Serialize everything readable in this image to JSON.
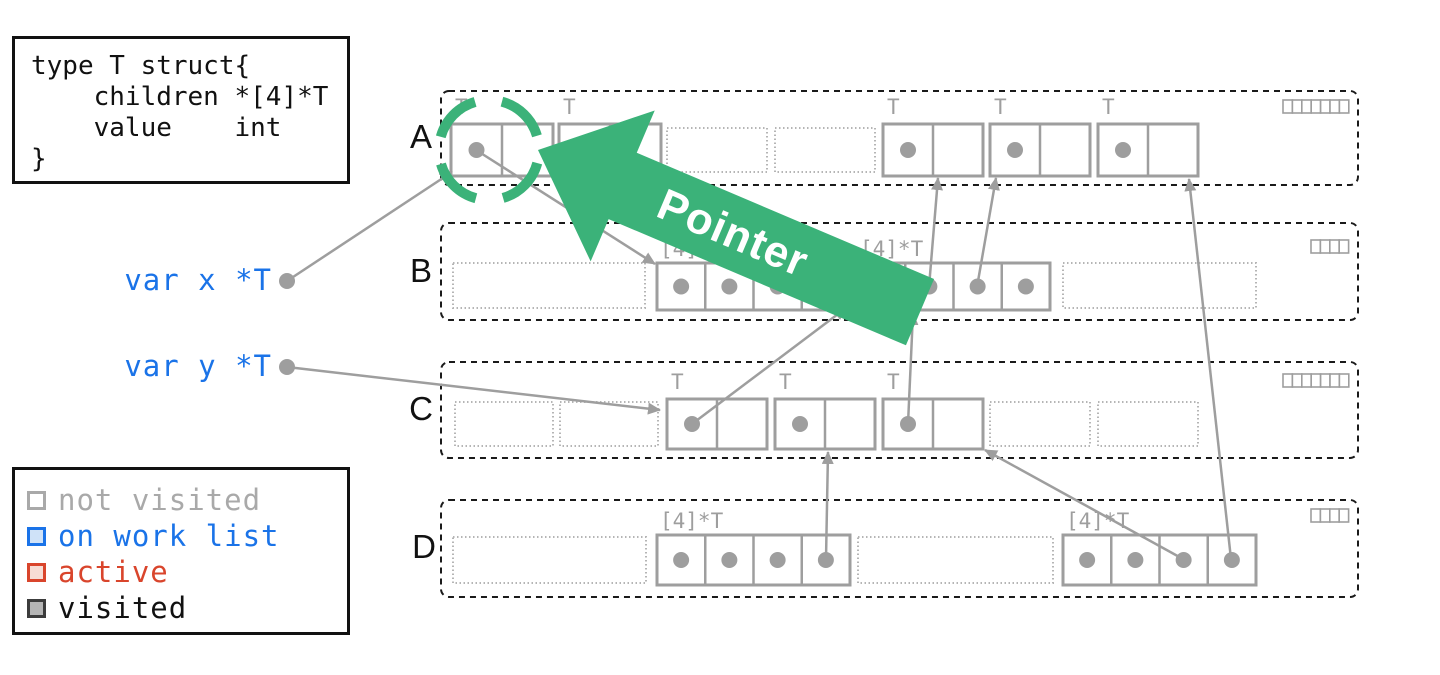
{
  "canvas": {
    "w": 1440,
    "h": 675
  },
  "colors": {
    "object_stroke": "#9e9e9e",
    "free_stroke": "#b5b5b5",
    "dot": "#9e9e9e",
    "edge": "#9e9e9e",
    "row_border": "#1a1a1a",
    "label_gray": "#9e9e9e",
    "text_black": "#111111",
    "blue": "#1a73e8",
    "green": "#3bb279",
    "white": "#ffffff"
  },
  "code_box": {
    "lines": [
      "type T struct{",
      "    children *[4]*T",
      "    value    int",
      "}"
    ]
  },
  "legend": {
    "items": [
      {
        "label": "not visited",
        "swatch_stroke": "#a9a9a9",
        "swatch_fill": "#ffffff",
        "text_color": "#a9a9a9"
      },
      {
        "label": "on work list",
        "swatch_stroke": "#1a73e8",
        "swatch_fill": "#cfe2f8",
        "text_color": "#1a73e8"
      },
      {
        "label": "active",
        "swatch_stroke": "#d9452c",
        "swatch_fill": "#f7dcd4",
        "text_color": "#d9452c"
      },
      {
        "label": "visited",
        "swatch_stroke": "#3c3c3c",
        "swatch_fill": "#b5b5b5",
        "text_color": "#111111"
      }
    ]
  },
  "variables": [
    {
      "label": "var x *T",
      "text_x": 272,
      "text_y": 290,
      "dot_x": 287,
      "dot_y": 281
    },
    {
      "label": "var y *T",
      "text_x": 272,
      "text_y": 376,
      "dot_x": 287,
      "dot_y": 367
    }
  ],
  "pointer_arrow": {
    "label": "Pointer",
    "tip_x": 538,
    "tip_y": 150,
    "angle": 23,
    "length": 415,
    "half_width": 36,
    "head_len": 92,
    "head_half_width": 82,
    "text_along": 212,
    "text_size": 44
  },
  "focus_ring": {
    "cx": 489,
    "cy": 150,
    "r": 50,
    "stroke_width": 10,
    "dash": "51 27.5",
    "rotate": -75
  },
  "rows": [
    {
      "label": "A",
      "label_x": 421,
      "label_y": 148,
      "box": {
        "x": 441,
        "y": 91,
        "w": 917,
        "h": 94
      },
      "mini": {
        "x": 1283,
        "y": 100,
        "count": 7,
        "cw": 9.4,
        "ch": 13
      },
      "objects": [
        {
          "kind": "struct",
          "x": 451,
          "y": 124,
          "w": 102,
          "h": 52,
          "label": "T",
          "dot": true
        },
        {
          "kind": "struct",
          "x": 559,
          "y": 124,
          "w": 102,
          "h": 52,
          "label": "T",
          "dot": true
        },
        {
          "kind": "free",
          "x": 667,
          "y": 128,
          "w": 100,
          "h": 44
        },
        {
          "kind": "free",
          "x": 775,
          "y": 128,
          "w": 100,
          "h": 44
        },
        {
          "kind": "struct",
          "x": 883,
          "y": 124,
          "w": 100,
          "h": 52,
          "label": "T",
          "dot": true
        },
        {
          "kind": "struct",
          "x": 990,
          "y": 124,
          "w": 100,
          "h": 52,
          "label": "T",
          "dot": true
        },
        {
          "kind": "struct",
          "x": 1098,
          "y": 124,
          "w": 100,
          "h": 52,
          "label": "T",
          "dot": true
        }
      ]
    },
    {
      "label": "B",
      "label_x": 421,
      "label_y": 282,
      "box": {
        "x": 441,
        "y": 223,
        "w": 917,
        "h": 97
      },
      "mini": {
        "x": 1311,
        "y": 240,
        "count": 4,
        "cw": 9.4,
        "ch": 13
      },
      "objects": [
        {
          "kind": "freewide",
          "x": 453,
          "y": 263,
          "w": 192,
          "h": 45
        },
        {
          "kind": "array",
          "x": 657,
          "y": 263,
          "w": 193,
          "h": 47,
          "label": "[4]*T",
          "cells": 4,
          "dots": [
            1,
            1,
            1,
            1
          ]
        },
        {
          "kind": "array",
          "x": 857,
          "y": 263,
          "w": 193,
          "h": 47,
          "label": "[4]*T",
          "cells": 4,
          "dots": [
            1,
            1,
            1,
            1
          ]
        },
        {
          "kind": "freewide",
          "x": 1063,
          "y": 263,
          "w": 193,
          "h": 45
        }
      ]
    },
    {
      "label": "C",
      "label_x": 421,
      "label_y": 420,
      "box": {
        "x": 441,
        "y": 362,
        "w": 917,
        "h": 96
      },
      "mini": {
        "x": 1283,
        "y": 374,
        "count": 7,
        "cw": 9.4,
        "ch": 13
      },
      "objects": [
        {
          "kind": "free",
          "x": 455,
          "y": 402,
          "w": 98,
          "h": 44
        },
        {
          "kind": "free",
          "x": 560,
          "y": 402,
          "w": 98,
          "h": 44
        },
        {
          "kind": "struct",
          "x": 667,
          "y": 399,
          "w": 100,
          "h": 50,
          "label": "T",
          "dot": true
        },
        {
          "kind": "struct",
          "x": 775,
          "y": 399,
          "w": 100,
          "h": 50,
          "label": "T",
          "dot": true
        },
        {
          "kind": "struct",
          "x": 883,
          "y": 399,
          "w": 100,
          "h": 50,
          "label": "T",
          "dot": true
        },
        {
          "kind": "free",
          "x": 990,
          "y": 402,
          "w": 100,
          "h": 44
        },
        {
          "kind": "free",
          "x": 1098,
          "y": 402,
          "w": 100,
          "h": 44
        }
      ]
    },
    {
      "label": "D",
      "label_x": 424,
      "label_y": 558,
      "box": {
        "x": 441,
        "y": 500,
        "w": 917,
        "h": 97
      },
      "mini": {
        "x": 1311,
        "y": 509,
        "count": 4,
        "cw": 9.4,
        "ch": 13
      },
      "objects": [
        {
          "kind": "freewide",
          "x": 453,
          "y": 537,
          "w": 193,
          "h": 46
        },
        {
          "kind": "array",
          "x": 657,
          "y": 535,
          "w": 193,
          "h": 50,
          "label": "[4]*T",
          "cells": 4,
          "dots": [
            1,
            1,
            1,
            1
          ]
        },
        {
          "kind": "freewide",
          "x": 858,
          "y": 537,
          "w": 195,
          "h": 46
        },
        {
          "kind": "array",
          "x": 1063,
          "y": 535,
          "w": 193,
          "h": 50,
          "label": "[4]*T",
          "cells": 4,
          "dots": [
            1,
            1,
            1,
            1
          ]
        }
      ]
    }
  ],
  "edges": [
    {
      "x1": 287,
      "y1": 281,
      "x2": 452,
      "y2": 172
    },
    {
      "x1": 476,
      "y1": 150,
      "x2": 655,
      "y2": 264
    },
    {
      "x1": 287,
      "y1": 367,
      "x2": 660,
      "y2": 410
    },
    {
      "x1": 692,
      "y1": 424,
      "x2": 846,
      "y2": 308
    },
    {
      "x1": 908,
      "y1": 424,
      "x2": 913,
      "y2": 313
    },
    {
      "x1": 929,
      "y1": 287,
      "x2": 938,
      "y2": 178
    },
    {
      "x1": 977,
      "y1": 287,
      "x2": 996,
      "y2": 178
    },
    {
      "x1": 826,
      "y1": 559,
      "x2": 828,
      "y2": 452
    },
    {
      "x1": 1183,
      "y1": 559,
      "x2": 985,
      "y2": 450
    },
    {
      "x1": 1231,
      "y1": 559,
      "x2": 1189,
      "y2": 179
    }
  ]
}
